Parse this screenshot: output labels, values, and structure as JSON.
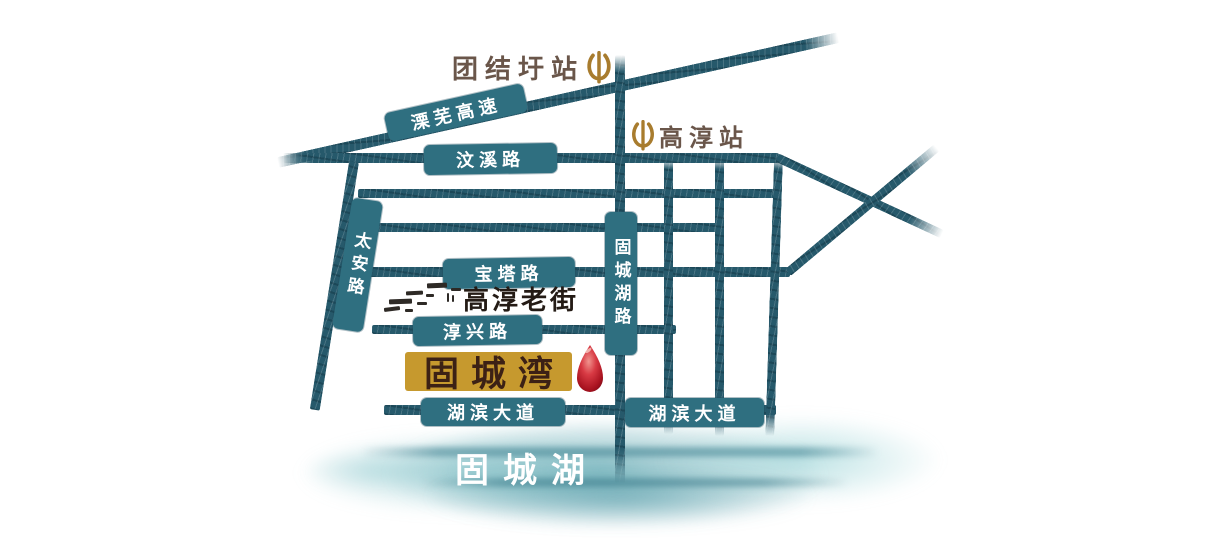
{
  "stations": {
    "tuanjiewei": {
      "label": "团结圩站",
      "icon": "railway-logo-icon"
    },
    "gaochun": {
      "label": "高淳站",
      "icon": "railway-logo-icon"
    }
  },
  "roads": {
    "expressway": {
      "label": "溧芜高速"
    },
    "wenxi": {
      "label": "汶溪路"
    },
    "taian": {
      "label": "太安路"
    },
    "baota": {
      "label": "宝塔路"
    },
    "chunxing": {
      "label": "淳兴路"
    },
    "guchenghu_lu": {
      "label": "固城湖路"
    },
    "hubin_west": {
      "label": "湖滨大道"
    },
    "hubin_east": {
      "label": "湖滨大道"
    }
  },
  "landmarks": {
    "old_street": {
      "label": "高淳老街"
    },
    "resort": {
      "label": "固城湾",
      "marker": "map-pin"
    },
    "lake": {
      "label": "固城湖"
    }
  },
  "colors": {
    "road_teal": "#26596b",
    "label_teal": "#2f6f80",
    "gold_badge": "#c6992e",
    "station_text": "#6a564a",
    "icon_gold": "#a87c2e",
    "pin_red": "#c21f30",
    "dark_text": "#3c2115",
    "lake_wash": "#5aacb5"
  }
}
